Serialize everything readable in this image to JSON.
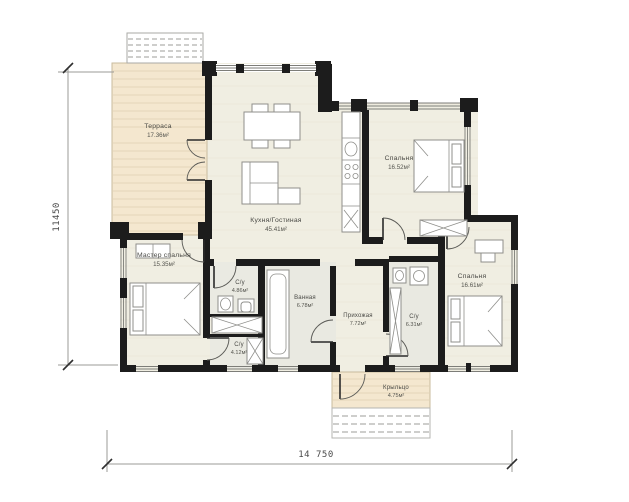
{
  "plan": {
    "title": "one-storey house floor plan",
    "rooms": [
      {
        "name": "Терраса",
        "area": "17.36м²"
      },
      {
        "name": "Кухня/Гостиная",
        "area": "45.41м²"
      },
      {
        "name": "Спальня",
        "area": "16.52м²"
      },
      {
        "name": "Мастер спальня",
        "area": "15.35м²"
      },
      {
        "name": "С/у",
        "area": "4.86м²"
      },
      {
        "name": "С/у",
        "area": "4.12м²"
      },
      {
        "name": "Ванная",
        "area": "6.78м²"
      },
      {
        "name": "Прихожая",
        "area": "7.72м²"
      },
      {
        "name": "С/у",
        "area": "6.31м²"
      },
      {
        "name": "Спальня",
        "area": "16.61м²"
      },
      {
        "name": "Крыльцо",
        "area": "4.75м²"
      }
    ],
    "dimensions": {
      "height": "11450",
      "width": "14 750"
    },
    "colors": {
      "wall": "#1c1c1c",
      "floor": "#f0eee2",
      "bath_floor": "#e9e9e1",
      "deck": "#f4e7cf",
      "deck_line": "#e5d6b8",
      "dim_line": "#9b9b97"
    }
  }
}
